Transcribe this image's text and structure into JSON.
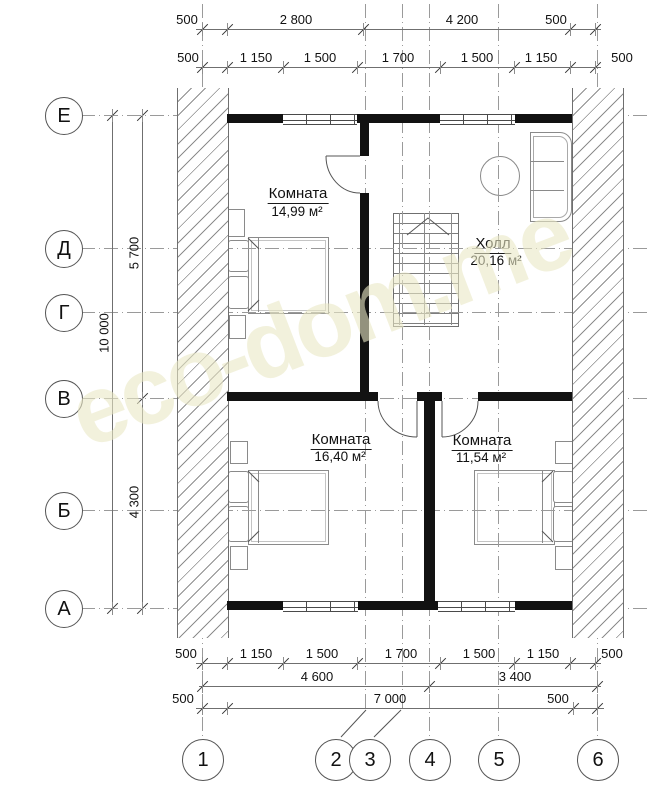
{
  "watermark": {
    "text": "eco-dom.me"
  },
  "axis_rows": [
    {
      "label": "Е"
    },
    {
      "label": "Д"
    },
    {
      "label": "Г"
    },
    {
      "label": "В"
    },
    {
      "label": "Б"
    },
    {
      "label": "А"
    }
  ],
  "axis_cols": [
    {
      "label": "1"
    },
    {
      "label": "2"
    },
    {
      "label": "3"
    },
    {
      "label": "4"
    },
    {
      "label": "5"
    },
    {
      "label": "6"
    }
  ],
  "dims": {
    "top1": [
      {
        "v": "500"
      },
      {
        "v": "2 800"
      },
      {
        "v": "4 200"
      },
      {
        "v": "500"
      }
    ],
    "top2": [
      {
        "v": "500"
      },
      {
        "v": "1 150"
      },
      {
        "v": "1 500"
      },
      {
        "v": "1 700"
      },
      {
        "v": "1 500"
      },
      {
        "v": "1 150"
      },
      {
        "v": "500"
      }
    ],
    "bottom1": [
      {
        "v": "500"
      },
      {
        "v": "1 150"
      },
      {
        "v": "1 500"
      },
      {
        "v": "1 700"
      },
      {
        "v": "1 500"
      },
      {
        "v": "1 150"
      },
      {
        "v": "500"
      }
    ],
    "bottom2": [
      {
        "v": "4 600"
      },
      {
        "v": "3 400"
      }
    ],
    "bottom3": [
      {
        "v": "500"
      },
      {
        "v": "7 000"
      },
      {
        "v": "500"
      }
    ],
    "left": {
      "outer": "10 000",
      "upper": "5 700",
      "lower": "4 300"
    }
  },
  "rooms": [
    {
      "name": "Комната",
      "area": "14,99 м²"
    },
    {
      "name": "Холл",
      "area": "20,16 м²"
    },
    {
      "name": "Комната",
      "area": "16,40 м²"
    },
    {
      "name": "Комната",
      "area": "11,54 м²"
    }
  ],
  "colors": {
    "wall": "#121212",
    "thin_line": "#8a8a8a",
    "grid": "#9a9a9a",
    "watermark": "#e9e7c4"
  }
}
